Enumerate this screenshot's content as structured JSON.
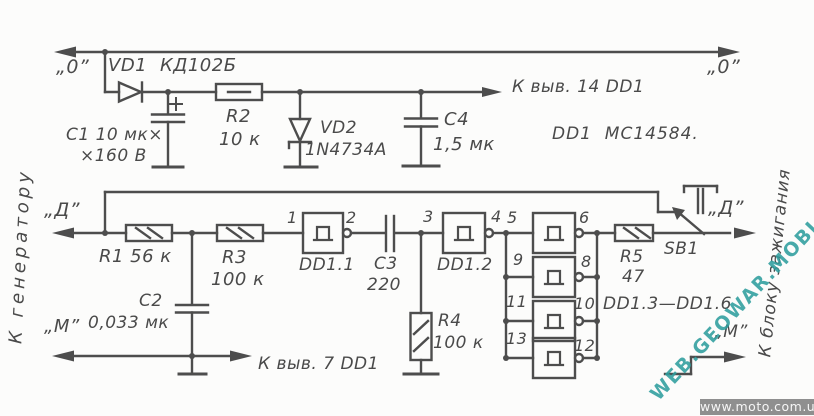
{
  "rails": {
    "left": "К генератору",
    "right": "К блоку зажигания"
  },
  "terminals": {
    "o_left": "„0”",
    "d_left": "„Д”",
    "m_left": "„М”",
    "o_right": "„0”",
    "d_right": "„Д”",
    "m_right": "„М”"
  },
  "parts": {
    "vd1": {
      "name": "VD1",
      "type": "КД102Б"
    },
    "c1": {
      "line1": "C1 10 мк×",
      "line2": "×160 В"
    },
    "r2": {
      "name": "R2",
      "value": "10 к"
    },
    "vd2": {
      "name": "VD2",
      "type": "1N4734A"
    },
    "c4": {
      "name": "C4",
      "value": "1,5 мк"
    },
    "r1": {
      "label": "R1 56 к"
    },
    "r3": {
      "name": "R3",
      "value": "100 к"
    },
    "c2": {
      "name": "C2",
      "value": "0,033 мк"
    },
    "c3": {
      "name": "C3",
      "value": "220"
    },
    "r4": {
      "name": "R4",
      "value": "100 к"
    },
    "r5": {
      "name": "R5",
      "value": "47"
    },
    "sb1": {
      "label": "SB1"
    },
    "dd11": {
      "label": "DD1.1"
    },
    "dd12": {
      "label": "DD1.2"
    },
    "dd13_16": {
      "label": "DD1.3—DD1.6"
    }
  },
  "notes": {
    "ic": "DD1  MC14584.",
    "to_pin14": "К выв. 14 DD1",
    "to_pin7": "К выв. 7 DD1"
  },
  "pins": {
    "p1": "1",
    "p2": "2",
    "p3": "3",
    "p4": "4",
    "p5": "5",
    "p6": "6",
    "p8": "8",
    "p9": "9",
    "p10": "10",
    "p11": "11",
    "p12": "12",
    "p13": "13"
  },
  "colors": {
    "line": "#4d4d4d",
    "watermark": "#2f9e9e",
    "site_bar_bg": "#8f8f8f"
  },
  "watermarks": {
    "diagonal": "WEB.GEOWAR.MOBI",
    "site": "www.moto.com.ua"
  }
}
